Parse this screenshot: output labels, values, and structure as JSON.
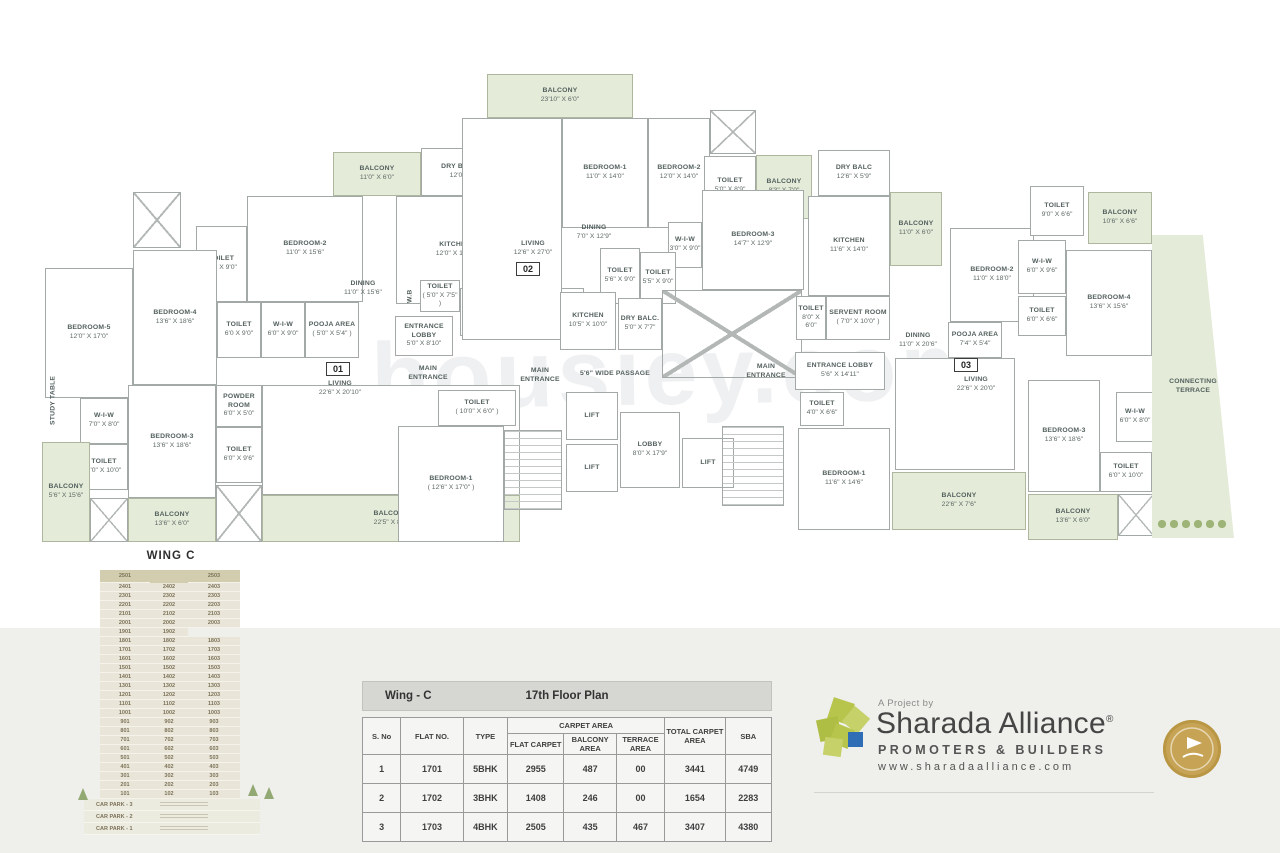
{
  "colors": {
    "band": "#efefec",
    "balcony_green": "#e4ebd8",
    "wall_gray": "#a3a9a7",
    "stack_beige": "#e9e6d9",
    "stack_top_beige": "#d2cdae",
    "brand_green": "#b7c54d",
    "brand_blue": "#2f6db5",
    "badge_gold": "#c7a455"
  },
  "plan": {
    "watermark": "housiey.com",
    "markers": [
      {
        "label": "01",
        "x": 326,
        "y": 362
      },
      {
        "label": "02",
        "x": 516,
        "y": 262
      },
      {
        "label": "03",
        "x": 954,
        "y": 358
      }
    ],
    "rooms": [
      {
        "k": "balcony",
        "n": "BALCONY",
        "d": "11'0\" X 6'0\"",
        "x": 333,
        "y": 152,
        "w": 88,
        "h": 44
      },
      {
        "k": "room",
        "n": "DRY BALCONY",
        "d": "12'0\" X 6'0\"",
        "x": 421,
        "y": 148,
        "w": 92,
        "h": 48
      },
      {
        "k": "room",
        "n": "BEDROOM-2",
        "d": "11'0\" X 15'6\"",
        "x": 247,
        "y": 196,
        "w": 116,
        "h": 106
      },
      {
        "k": "room",
        "n": "TOILET",
        "d": "6'0\" X 9'0\"",
        "x": 196,
        "y": 226,
        "w": 51,
        "h": 76
      },
      {
        "k": "duct",
        "x": 133,
        "y": 192,
        "w": 48,
        "h": 56
      },
      {
        "k": "room",
        "n": "BEDROOM-4",
        "d": "13'6\" X 18'6\"",
        "x": 133,
        "y": 250,
        "w": 84,
        "h": 135
      },
      {
        "k": "room",
        "n": "BEDROOM-5",
        "d": "12'0\" X 17'0\"",
        "x": 45,
        "y": 268,
        "w": 88,
        "h": 130
      },
      {
        "k": "room",
        "n": "TOILET",
        "d": "6'0 X 9'0\"",
        "x": 217,
        "y": 302,
        "w": 44,
        "h": 56
      },
      {
        "k": "room",
        "n": "W-I-W",
        "d": "6'0\" X 9'0\"",
        "x": 261,
        "y": 302,
        "w": 44,
        "h": 56
      },
      {
        "k": "room",
        "n": "POOJA AREA",
        "d": "( 5'0\" X 5'4\" )",
        "x": 305,
        "y": 302,
        "w": 54,
        "h": 56
      },
      {
        "k": "room",
        "n": "KITCHEN",
        "d": "12'0\" X 14'6\"",
        "x": 396,
        "y": 196,
        "w": 118,
        "h": 108
      },
      {
        "k": "label",
        "n": "DINING",
        "d": "11'0\" X 15'6\"",
        "x": 322,
        "y": 276,
        "w": 82,
        "h": 26
      },
      {
        "k": "vlabel",
        "n": "STUDY TABLE",
        "x": 44,
        "y": 368,
        "w": 20,
        "h": 64
      },
      {
        "k": "room",
        "n": "W-I-W",
        "d": "7'0\" X 8'0\"",
        "x": 80,
        "y": 398,
        "w": 48,
        "h": 46
      },
      {
        "k": "room",
        "n": "TOILET",
        "d": "7'0\" X 10'0\"",
        "x": 80,
        "y": 444,
        "w": 48,
        "h": 46
      },
      {
        "k": "room",
        "n": "BEDROOM-3",
        "d": "13'6\" X 18'6\"",
        "x": 128,
        "y": 385,
        "w": 88,
        "h": 113
      },
      {
        "k": "room",
        "n": "POWDER ROOM",
        "d": "6'0\" X 5'0\"",
        "x": 216,
        "y": 385,
        "w": 46,
        "h": 42
      },
      {
        "k": "room",
        "n": "TOILET",
        "d": "6'0\" X 9'6\"",
        "x": 216,
        "y": 427,
        "w": 46,
        "h": 56
      },
      {
        "k": "balcony",
        "n": "BALCONY",
        "d": "5'6\" X 15'6\"",
        "x": 42,
        "y": 442,
        "w": 48,
        "h": 100
      },
      {
        "k": "duct",
        "x": 90,
        "y": 498,
        "w": 38,
        "h": 44
      },
      {
        "k": "balcony",
        "n": "BALCONY",
        "d": "13'6\" X 6'0\"",
        "x": 128,
        "y": 498,
        "w": 88,
        "h": 44
      },
      {
        "k": "duct",
        "x": 216,
        "y": 485,
        "w": 46,
        "h": 57
      },
      {
        "k": "room",
        "x": 262,
        "y": 385,
        "w": 258,
        "h": 110
      },
      {
        "k": "label",
        "n": "LIVING",
        "d": "22'6\" X 20'10\"",
        "x": 300,
        "y": 376,
        "w": 80,
        "h": 26
      },
      {
        "k": "balcony",
        "n": "BALCONY",
        "d": "22'5\" X 8'0\"",
        "x": 262,
        "y": 495,
        "w": 258,
        "h": 47
      },
      {
        "k": "vlabel",
        "n": "W.B",
        "x": 404,
        "y": 280,
        "w": 14,
        "h": 32
      },
      {
        "k": "room",
        "n": "TOILET",
        "d": "( 5'0\" X 7'5\" )",
        "x": 420,
        "y": 280,
        "w": 40,
        "h": 32
      },
      {
        "k": "room",
        "n": "SERVENT ROOM",
        "d": "( 8'0\" X 10'0\" )",
        "x": 460,
        "y": 288,
        "w": 64,
        "h": 48
      },
      {
        "k": "room",
        "n": "ENTRANCE LOBBY",
        "d": "5'8\" X 10'0\"",
        "x": 526,
        "y": 288,
        "w": 58,
        "h": 48
      },
      {
        "k": "room",
        "n": "ENTRANCE LOBBY",
        "d": "5'0\" X 8'10\"",
        "x": 395,
        "y": 316,
        "w": 58,
        "h": 40
      },
      {
        "k": "label",
        "n": "MAIN ENTRANCE",
        "x": 400,
        "y": 362,
        "w": 56,
        "h": 24
      },
      {
        "k": "label",
        "n": "MAIN ENTRANCE",
        "x": 512,
        "y": 364,
        "w": 56,
        "h": 24
      },
      {
        "k": "label",
        "n": "5'6\" WIDE PASSAGE",
        "x": 570,
        "y": 366,
        "w": 90,
        "h": 16
      },
      {
        "k": "room",
        "n": "TOILET",
        "d": "( 10'0\" X 6'0\" )",
        "x": 438,
        "y": 390,
        "w": 78,
        "h": 36
      },
      {
        "k": "room",
        "n": "BEDROOM-1",
        "d": "( 12'6\" X 17'0\" )",
        "x": 398,
        "y": 426,
        "w": 106,
        "h": 116
      },
      {
        "k": "stair",
        "x": 504,
        "y": 430,
        "w": 58,
        "h": 80
      },
      {
        "k": "room",
        "n": "LIFT",
        "x": 566,
        "y": 392,
        "w": 52,
        "h": 48
      },
      {
        "k": "room",
        "n": "LIFT",
        "x": 566,
        "y": 444,
        "w": 52,
        "h": 48
      },
      {
        "k": "room",
        "n": "LOBBY",
        "d": "8'0\" X 17'9\"",
        "x": 620,
        "y": 412,
        "w": 60,
        "h": 76
      },
      {
        "k": "room",
        "n": "LIFT",
        "x": 682,
        "y": 438,
        "w": 52,
        "h": 50
      },
      {
        "k": "balcony",
        "n": "BALCONY",
        "d": "23'10\" X 6'0\"",
        "x": 487,
        "y": 74,
        "w": 146,
        "h": 44
      },
      {
        "k": "room",
        "x": 462,
        "y": 118,
        "w": 100,
        "h": 222
      },
      {
        "k": "label",
        "n": "LIVING",
        "d": "12'6\" X 27'0\"",
        "x": 495,
        "y": 236,
        "w": 76,
        "h": 26
      },
      {
        "k": "room",
        "n": "BEDROOM-1",
        "d": "11'0\" X 14'0\"",
        "x": 562,
        "y": 118,
        "w": 86,
        "h": 110
      },
      {
        "k": "room",
        "n": "BEDROOM-2",
        "d": "12'0\" X 14'0\"",
        "x": 648,
        "y": 118,
        "w": 62,
        "h": 110
      },
      {
        "k": "duct",
        "x": 710,
        "y": 110,
        "w": 46,
        "h": 44
      },
      {
        "k": "room",
        "n": "TOILET",
        "d": "5'0\" X 8'9\"",
        "x": 704,
        "y": 156,
        "w": 52,
        "h": 60
      },
      {
        "k": "balcony",
        "n": "BALCONY",
        "d": "8'3\" X 7'0\"",
        "x": 756,
        "y": 155,
        "w": 56,
        "h": 64
      },
      {
        "k": "label",
        "n": "DINING",
        "d": "7'0\" X 12'9\"",
        "x": 565,
        "y": 220,
        "w": 58,
        "h": 26
      },
      {
        "k": "room",
        "n": "W-I-W",
        "d": "3'0\" X 9'0\"",
        "x": 668,
        "y": 222,
        "w": 34,
        "h": 46
      },
      {
        "k": "room",
        "n": "TOILET",
        "d": "5'6\" X 9'0\"",
        "x": 600,
        "y": 248,
        "w": 40,
        "h": 56
      },
      {
        "k": "room",
        "n": "TOILET",
        "d": "5'5\" X 9'0\"",
        "x": 640,
        "y": 252,
        "w": 36,
        "h": 52
      },
      {
        "k": "room",
        "n": "BEDROOM-3",
        "d": "14'7\" X 12'9\"",
        "x": 702,
        "y": 190,
        "w": 102,
        "h": 100
      },
      {
        "k": "room",
        "n": "KITCHEN",
        "d": "10'5\" X 10'0\"",
        "x": 560,
        "y": 292,
        "w": 56,
        "h": 58
      },
      {
        "k": "room",
        "n": "DRY BALC.",
        "d": "5'0\" X 7'7\"",
        "x": 618,
        "y": 298,
        "w": 44,
        "h": 52
      },
      {
        "k": "duct",
        "x": 662,
        "y": 290,
        "w": 140,
        "h": 88
      },
      {
        "k": "room",
        "n": "KITCHEN",
        "d": "11'6\" X 14'0\"",
        "x": 808,
        "y": 196,
        "w": 82,
        "h": 100
      },
      {
        "k": "room",
        "n": "DRY BALC",
        "d": "12'6\" X 5'9\"",
        "x": 818,
        "y": 150,
        "w": 72,
        "h": 46
      },
      {
        "k": "room",
        "n": "TOILET",
        "d": "8'0\" X 6'0\"",
        "x": 796,
        "y": 296,
        "w": 30,
        "h": 44
      },
      {
        "k": "room",
        "n": "SERVENT ROOM",
        "d": "( 7'0\" X 10'0\" )",
        "x": 826,
        "y": 296,
        "w": 64,
        "h": 44
      },
      {
        "k": "balcony",
        "n": "BALCONY",
        "d": "11'0\" X 6'0\"",
        "x": 890,
        "y": 192,
        "w": 52,
        "h": 74
      },
      {
        "k": "room",
        "n": "BEDROOM-2",
        "d": "11'0\" X 18'0\"",
        "x": 950,
        "y": 228,
        "w": 84,
        "h": 94
      },
      {
        "k": "room",
        "n": "TOILET",
        "d": "9'0\" X 6'6\"",
        "x": 1030,
        "y": 186,
        "w": 54,
        "h": 50
      },
      {
        "k": "balcony",
        "n": "BALCONY",
        "d": "10'6\" X 6'6\"",
        "x": 1088,
        "y": 192,
        "w": 64,
        "h": 52
      },
      {
        "k": "room",
        "n": "W-I-W",
        "d": "6'0\" X 9'6\"",
        "x": 1018,
        "y": 240,
        "w": 48,
        "h": 54
      },
      {
        "k": "room",
        "n": "TOILET",
        "d": "6'0\" X 6'6\"",
        "x": 1018,
        "y": 296,
        "w": 48,
        "h": 40
      },
      {
        "k": "room",
        "n": "BEDROOM-4",
        "d": "13'6\" X 15'6\"",
        "x": 1066,
        "y": 250,
        "w": 86,
        "h": 106
      },
      {
        "k": "label",
        "n": "DINING",
        "d": "11'0\" X 20'6\"",
        "x": 888,
        "y": 328,
        "w": 60,
        "h": 26
      },
      {
        "k": "room",
        "n": "POOJA AREA",
        "d": "7'4\" X 5'4\"",
        "x": 948,
        "y": 322,
        "w": 54,
        "h": 36
      },
      {
        "k": "label",
        "n": "MAIN ENTRANCE",
        "x": 738,
        "y": 360,
        "w": 56,
        "h": 24
      },
      {
        "k": "room",
        "n": "ENTRANCE LOBBY",
        "d": "5'6\" X 14'11\"",
        "x": 795,
        "y": 352,
        "w": 90,
        "h": 38
      },
      {
        "k": "stair",
        "x": 722,
        "y": 426,
        "w": 62,
        "h": 80
      },
      {
        "k": "room",
        "n": "TOILET",
        "d": "4'0\" X 6'6\"",
        "x": 800,
        "y": 392,
        "w": 44,
        "h": 34
      },
      {
        "k": "room",
        "n": "BEDROOM-1",
        "d": "11'6\" X 14'6\"",
        "x": 798,
        "y": 428,
        "w": 92,
        "h": 102
      },
      {
        "k": "room",
        "x": 895,
        "y": 358,
        "w": 120,
        "h": 112
      },
      {
        "k": "label",
        "n": "LIVING",
        "d": "22'6\" X 20'0\"",
        "x": 938,
        "y": 372,
        "w": 76,
        "h": 26
      },
      {
        "k": "balcony",
        "n": "BALCONY",
        "d": "22'6\" X 7'6\"",
        "x": 892,
        "y": 472,
        "w": 134,
        "h": 58
      },
      {
        "k": "room",
        "n": "BEDROOM-3",
        "d": "13'6\" X 18'6\"",
        "x": 1028,
        "y": 380,
        "w": 72,
        "h": 112
      },
      {
        "k": "room",
        "n": "W-I-W",
        "d": "6'0\" X 8'0\"",
        "x": 1116,
        "y": 392,
        "w": 38,
        "h": 50
      },
      {
        "k": "room",
        "n": "TOILET",
        "d": "6'0\" X 10'0\"",
        "x": 1100,
        "y": 452,
        "w": 52,
        "h": 40
      },
      {
        "k": "balcony",
        "n": "BALCONY",
        "d": "13'6\" X 6'0\"",
        "x": 1028,
        "y": 494,
        "w": 90,
        "h": 46
      },
      {
        "k": "duct",
        "x": 1118,
        "y": 494,
        "w": 36,
        "h": 42
      },
      {
        "k": "terrace",
        "n": "CONNECTING TERRACE",
        "x": 1152,
        "y": 235,
        "w": 82,
        "h": 303
      },
      {
        "k": "bushes",
        "x": 1156,
        "y": 518,
        "w": 72,
        "h": 12
      }
    ]
  },
  "stack": {
    "title": "WING C",
    "floors": [
      [
        "2501",
        "",
        "2503"
      ],
      [
        "2401",
        "2402",
        "2403"
      ],
      [
        "2301",
        "2302",
        "2303"
      ],
      [
        "2201",
        "2202",
        "2203"
      ],
      [
        "2101",
        "2102",
        "2103"
      ],
      [
        "2001",
        "2002",
        "2003"
      ],
      [
        "1901",
        "1902",
        ""
      ],
      [
        "1801",
        "1802",
        "1803"
      ],
      [
        "1701",
        "1702",
        "1703"
      ],
      [
        "1601",
        "1602",
        "1603"
      ],
      [
        "1501",
        "1502",
        "1503"
      ],
      [
        "1401",
        "1402",
        "1403"
      ],
      [
        "1301",
        "1302",
        "1303"
      ],
      [
        "1201",
        "1202",
        "1203"
      ],
      [
        "1101",
        "1102",
        "1103"
      ],
      [
        "1001",
        "1002",
        "1003"
      ],
      [
        "901",
        "902",
        "903"
      ],
      [
        "801",
        "802",
        "803"
      ],
      [
        "701",
        "702",
        "703"
      ],
      [
        "601",
        "602",
        "603"
      ],
      [
        "501",
        "502",
        "503"
      ],
      [
        "401",
        "402",
        "403"
      ],
      [
        "301",
        "302",
        "303"
      ],
      [
        "201",
        "202",
        "203"
      ],
      [
        "101",
        "102",
        "103"
      ]
    ],
    "carpark": [
      "CAR PARK - 3",
      "CAR PARK - 2",
      "CAR PARK - 1"
    ]
  },
  "area_table": {
    "wing_label": "Wing - C",
    "floor_label": "17th Floor Plan",
    "columns": [
      "S. No",
      "FLAT NO.",
      "TYPE"
    ],
    "group_header": "CARPET AREA",
    "sub_columns": [
      "FLAT CARPET",
      "BALCONY AREA",
      "TERRACE AREA"
    ],
    "tail_columns": [
      "TOTAL CARPET AREA",
      "SBA"
    ],
    "rows": [
      [
        "1",
        "1701",
        "5BHK",
        "2955",
        "487",
        "00",
        "3441",
        "4749"
      ],
      [
        "2",
        "1702",
        "3BHK",
        "1408",
        "246",
        "00",
        "1654",
        "2283"
      ],
      [
        "3",
        "1703",
        "4BHK",
        "2505",
        "435",
        "467",
        "3407",
        "4380"
      ]
    ]
  },
  "branding": {
    "project_by": "A Project by",
    "name": "Sharada Alliance",
    "reg": "®",
    "tagline": "PROMOTERS & BUILDERS",
    "website": "www.sharadaalliance.com"
  }
}
